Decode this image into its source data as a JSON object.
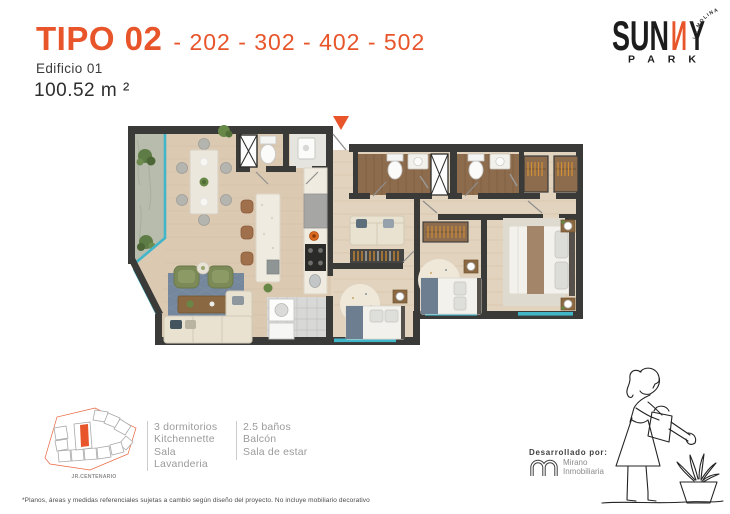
{
  "header": {
    "type_label": "TIPO 02",
    "unit_numbers": "- 202 - 302 - 402 - 502",
    "building": "Edificio 01",
    "area": "100.52 m ²"
  },
  "brand": {
    "name_start": "SUN",
    "name_accent_letter": "И",
    "name_end": "Y",
    "name_sub": "PARK",
    "tagline": "LA MOLINA"
  },
  "site_plan": {
    "street_label": "JR.CENTENARIO",
    "highlight_color": "#E8552B"
  },
  "features": {
    "col1": [
      "3 dormitorios",
      "Kitchennette",
      "Sala",
      "Lavanderia"
    ],
    "col2": [
      "2.5 baños",
      "Balcón",
      "Sala de estar"
    ]
  },
  "developer": {
    "heading": "Desarrollado por:",
    "name_line1": "Mirano",
    "name_line2": "Inmobiliaria"
  },
  "footnote": "*Planos, áreas y medidas referenciales sujetas a cambio según diseño del proyecto. No incluye mobiliario decorativo",
  "icons": {
    "entrance_marker": "orange-triangle-entrance",
    "girl_illustration": "girl-watering-plant-line-art",
    "developer_logo": "mirano-m-outline"
  },
  "colors": {
    "accent": "#E8552B",
    "wall": "#3A3A38",
    "floor_left": "#DBC9B2",
    "floor_right": "#E1D3BE",
    "glass": "#41B6C9",
    "wood": "#8D6B4D",
    "rug_blue": "#74879C",
    "text_dark": "#3A3A3A",
    "text_gray": "#9B9B9B"
  }
}
